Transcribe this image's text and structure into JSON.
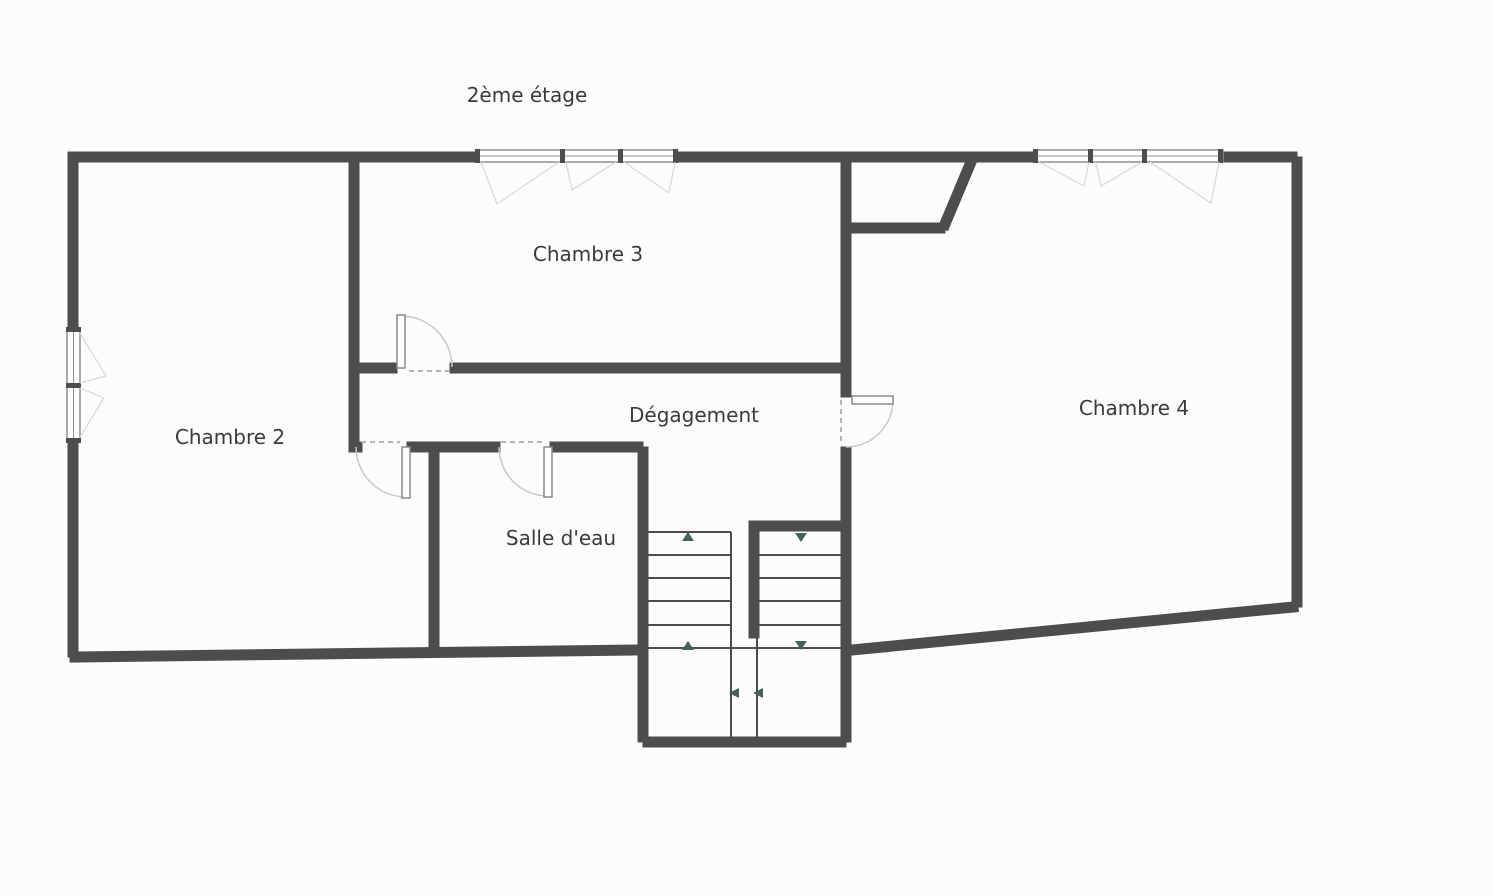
{
  "title": "2ème étage",
  "rooms": {
    "chambre2": "Chambre 2",
    "chambre3": "Chambre 3",
    "chambre4": "Chambre 4",
    "degagement": "Dégagement",
    "salle_deau": "Salle d'eau"
  },
  "icons": {
    "stair-up-arrow": "triangle-up",
    "stair-down-arrow": "triangle-down",
    "stair-turn-arrow": "triangle-left"
  },
  "colors": {
    "background": "#fcfcfc",
    "wall": "#4d4d4d",
    "door_arc": "#c9c9c9",
    "window_frame": "#8f8f8f",
    "swing": "#d8d8d8",
    "dash": "#b3b3b3",
    "arrow": "#44625a",
    "text": "#3a3a3a"
  }
}
